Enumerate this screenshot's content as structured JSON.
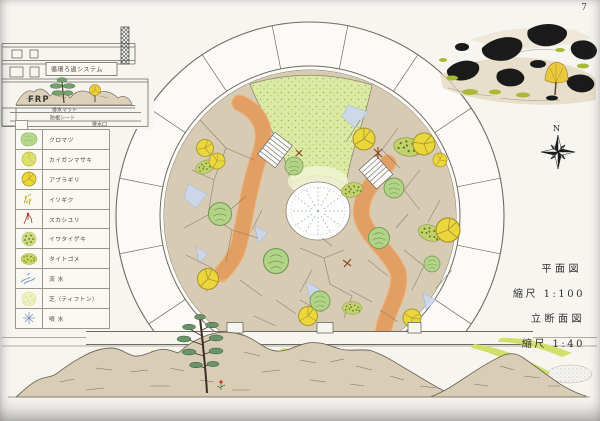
{
  "page": {
    "number": "7"
  },
  "section_detail": {
    "system_label": "循環ろ過システム",
    "frp_label": "FRP",
    "drain_mat_label": "排水マット",
    "root_sheet_label": "防根シート",
    "drain_outlet_label": "排水口"
  },
  "legend": {
    "items": [
      {
        "id": "kuromatsu",
        "label": "クロマツ"
      },
      {
        "id": "kaiganmasaki",
        "label": "カイガンマサキ"
      },
      {
        "id": "aburagiri",
        "label": "アブラギリ"
      },
      {
        "id": "isogiku",
        "label": "イソギク"
      },
      {
        "id": "sukashiyuri",
        "label": "スカシユリ"
      },
      {
        "id": "iwataigeki",
        "label": "イワタイゲキ"
      },
      {
        "id": "taitogome",
        "label": "タイトゴメ"
      },
      {
        "id": "ryusui",
        "label": "流 水"
      },
      {
        "id": "shiba",
        "label": "芝（ティフトン）"
      },
      {
        "id": "funsui",
        "label": "噴 水"
      }
    ]
  },
  "compass": {
    "north_label": "N"
  },
  "titleblock": {
    "plan_title": "平面図",
    "plan_scale": "縮尺 1:100",
    "section_title": "立断面図",
    "section_scale": "縮尺 1:40"
  },
  "colors": {
    "paper": "#f7f5f0",
    "ink": "#6a6a62",
    "rock_tan": "#d7cbb4",
    "path_orange": "#efae74",
    "turf_green": "#dbe9a4",
    "tree_yellow": "#ead73c",
    "tree_green": "#b2d388",
    "shrub_green": "#c3d16a",
    "water_blue": "#ccd8ee",
    "mountain_tan": "#d9cdb6",
    "sketch_black": "#1a1a1a"
  }
}
